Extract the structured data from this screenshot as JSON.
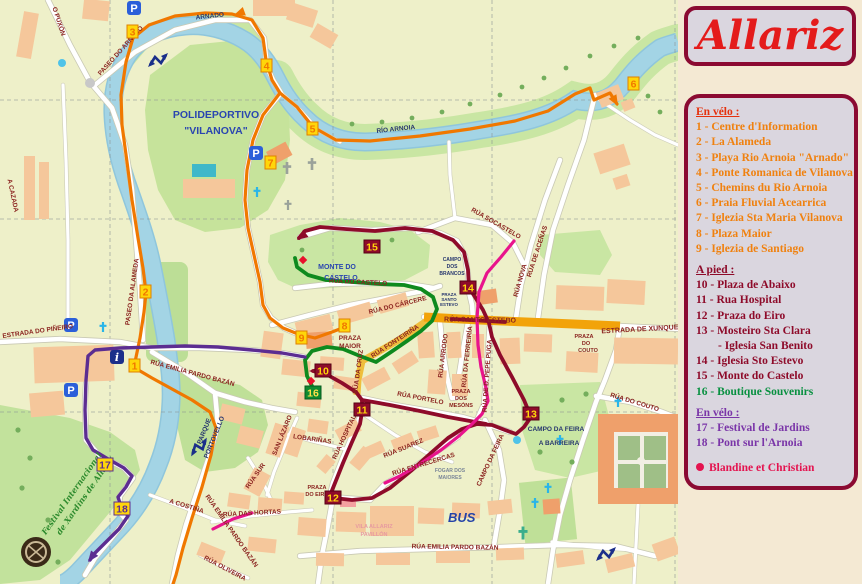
{
  "title": "Allariz",
  "legend": {
    "velo1_heading": "En vélo :",
    "velo1_items": [
      "1 - Centre d'Information",
      "2 - La Alameda",
      "3 - Playa Rio Arnoia \"Arnado\"",
      "4 - Ponte Romanica de Vilanova",
      "5 - Chemins du Rio Arnoia",
      "6 - Praia Fluvial Acearrica",
      "7 - Iglezia Sta Maria Vilanova",
      "8 - Plaza Maior",
      "9 - Iglezia de Santiago"
    ],
    "pied_heading": "A pied :",
    "pied_items": [
      "10 - Plaza de Abaixo",
      "11 - Rua Hospital",
      "12 - Praza do Eiro",
      "13 - Mosteiro Sta Clara",
      "- Iglesia San Benito",
      "14 - Iglesia Sto Estevo",
      "15 - Monte do Castelo"
    ],
    "boutique_item": "16 - Boutique Souvenirs",
    "velo2_heading": "En vélo :",
    "velo2_items": [
      "17 - Festival de Jardins",
      "18 - Pont sur l'Arnoia"
    ],
    "signature": "Blandine et Christian"
  },
  "map": {
    "markers": {
      "m1": "1",
      "m2": "2",
      "m3": "3",
      "m4": "4",
      "m5": "5",
      "m6": "6",
      "m7": "7",
      "m8": "8",
      "m9": "9",
      "m10": "10",
      "m11": "11",
      "m12": "12",
      "m13": "13",
      "m14": "14",
      "m15": "15",
      "m16": "16",
      "m17": "17",
      "m18": "18"
    },
    "icons": {
      "parking": "P",
      "info": "i"
    },
    "street_labels": {
      "puxon": "O PUXÓN",
      "paseo_arnado": "PASEO DO ARNADO",
      "cazada": "A CAZADA",
      "pineiro": "ESTRADA DO PIÑEIRO",
      "alameda": "PASEO DA ALAMEDA",
      "emilia1": "RÚA EMILIA PARDO BAZÁN",
      "socastelo": "RÚA SOCASTELO",
      "acenas": "RÚA DE ACEÑAS",
      "nova": "RÚA NOVA",
      "santo_estebo": "RÚA SANTO ESTEBO",
      "xunqueira": "ESTRADA DE XUNQUEIRA",
      "couto_rua": "RÚA DO COUTO",
      "carcere": "RÚA DO CÁRCERE",
      "castelo": "RÚA DO CASTELO",
      "fonteirina": "RÚA FONTEIRIÑA",
      "cruz": "RÚA DA CRUZ",
      "arrodo": "RÚA ARRODO",
      "ferreiria": "RÚA DA FERREIRÍA",
      "pepepuga": "RÚA DE D. PEPE PUGA",
      "portelo": "RÚA PORTELO",
      "hospital": "RÚA HOSPITAL",
      "suarez": "RÚA SUAREZ",
      "entrecercas": "RÚA ENTRECERCAS",
      "campo_feira_st": "CAMPO DA FEIRA",
      "lobarinas": "LOBARIÑAS",
      "lazaro": "SAN LÁZARO",
      "sur": "RÚA SUR",
      "hortas": "RÚA DAS HORTAS",
      "costina": "A COSTIÑA",
      "emilia2": "RÚA EMILIA PARDO BAZÁN",
      "emilia3": "RÚA EMILIA PARDO BAZÁN",
      "oliveira": "RÚA OLIVEIRA"
    },
    "place_labels": {
      "arnado": "ARNADO",
      "rio": "RÍO ARNOIA",
      "poli1": "POLIDEPORTIVO",
      "poli2": "\"VILANOVA\"",
      "monte1": "MONTE DO",
      "monte2": "CASTELO",
      "parque1": "PARQUE",
      "parque2": "PORTOVELLO",
      "feira": "CAMPO DA FEIRA",
      "barreira": "A BARREIRA",
      "brancos1": "CAMPO",
      "brancos2": "DOS",
      "brancos3": "BRANCOS",
      "pse1": "PRAZA",
      "pse2": "SANTO",
      "pse3": "ESTEVO",
      "pmaior1": "PRAZA",
      "pmaior2": "MAIOR",
      "eiro1": "PRAZA",
      "eiro2": "DO EIRO",
      "mesons1": "PRAZA",
      "mesons2": "DOS",
      "mesons3": "MESÓNS",
      "couto1": "PRAZA",
      "couto2": "DO",
      "couto3": "COUTO",
      "fogar1": "FOGAR DOS",
      "fogar2": "MAIORES",
      "pavillon1": "VILA ALLARIZ",
      "pavillon2": "PAVILLÓN",
      "bus": "BUS",
      "festival1": "Festival Internacional",
      "festival2": "de Xardíns de Allariz"
    },
    "colors": {
      "route_velo": "#F07800",
      "route_pied": "#8E0B2A",
      "route_boutique": "#0E8A1E",
      "route_velo2": "#5C2D91",
      "route_rose": "#E8148C",
      "river": "#A3D4E5",
      "main_road": "#F2A30A"
    }
  }
}
